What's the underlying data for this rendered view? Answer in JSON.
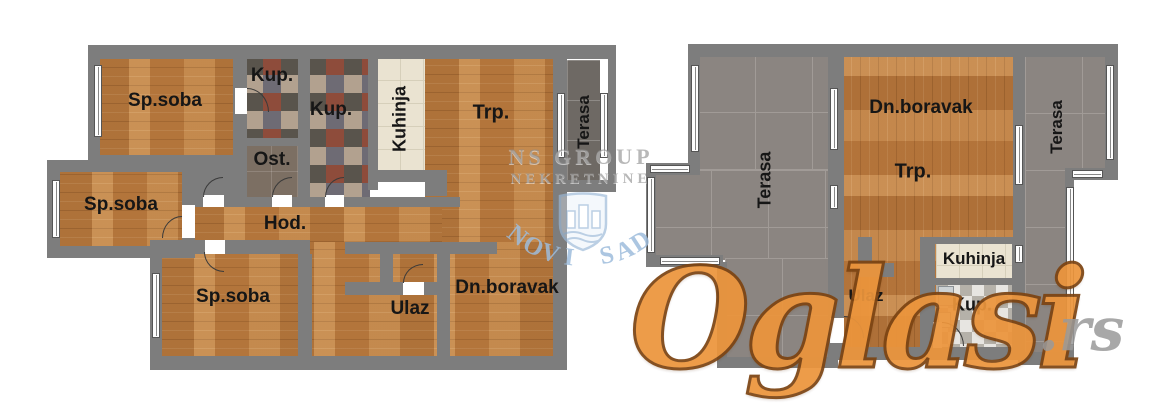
{
  "plans": {
    "left": {
      "labels": {
        "sp_soba_1": "Sp.soba",
        "kup_1": "Kup.",
        "kup_2": "Kup.",
        "ost": "Ost.",
        "kuhinja": "Kuhinja",
        "trp": "Trp.",
        "terasa": "Terasa",
        "sp_soba_2": "Sp.soba",
        "hod": "Hod.",
        "sp_soba_3": "Sp.soba",
        "ulaz": "Ulaz",
        "dn_boravak": "Dn.boravak"
      }
    },
    "right": {
      "labels": {
        "dn_boravak": "Dn.boravak",
        "trp": "Trp.",
        "terasa_left": "Terasa",
        "terasa_right": "Terasa",
        "kuhinja": "Kuhinja",
        "ulaz": "Ulaz",
        "kup": "Kup."
      }
    }
  },
  "watermarks": {
    "agency": {
      "line1": "NS GROUP",
      "line2": "NEKRETNINE",
      "city": "NOVI SAD"
    },
    "brand": {
      "name": "Oglasi",
      "tld": ".rs"
    }
  },
  "colors": {
    "wall": "#7d7d7d",
    "wood": "#c08448",
    "terrace_tile": "#8b8581",
    "accent_orange": "#e8913a",
    "watermark_blue": "#9ebcdc",
    "watermark_gray": "#9a9a9a"
  }
}
